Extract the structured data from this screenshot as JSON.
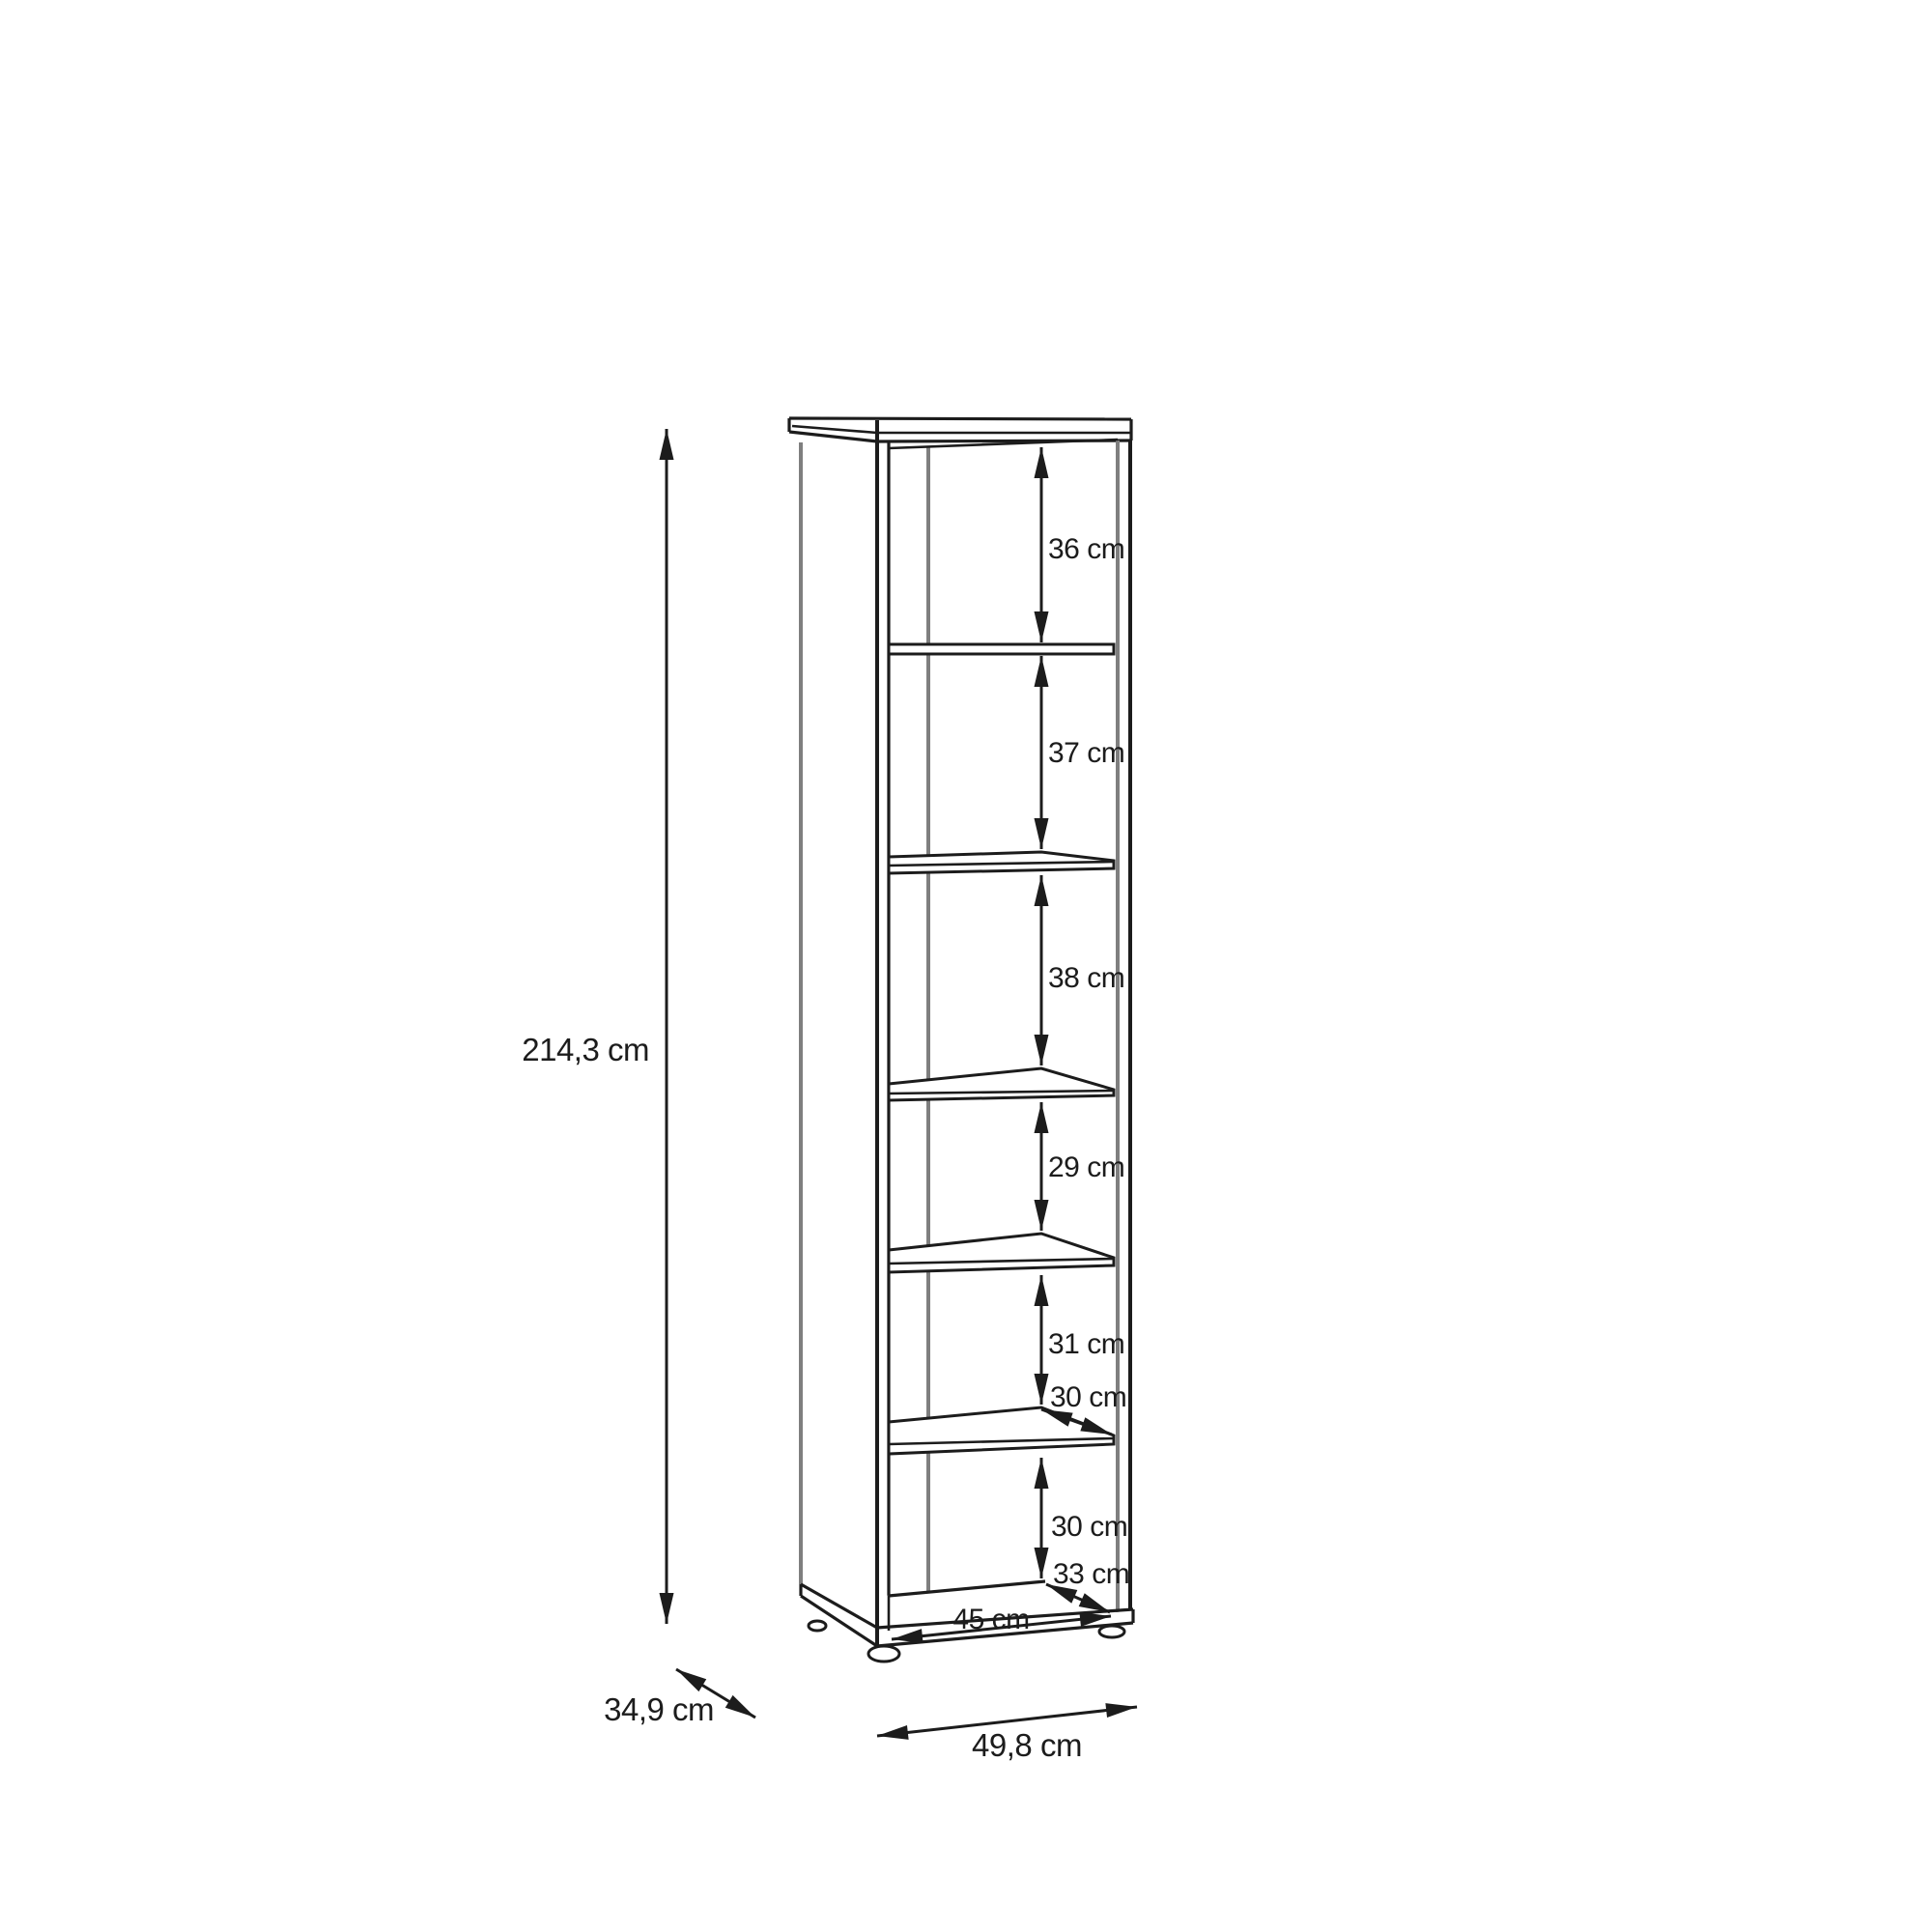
{
  "diagram": {
    "kind": "furniture-dimension-drawing",
    "subject": "tall open shelving unit with five shelves and adjustable feet",
    "unit": "cm",
    "colors": {
      "background": "#ffffff",
      "line": "#1c1c1c",
      "secondary_line": "#7f7f7f",
      "text": "#1c1c1c"
    },
    "overall": {
      "height": "214,3 cm",
      "width": "49,8 cm",
      "depth": "34,9 cm"
    },
    "interior": {
      "interior_width": "45 cm",
      "shelf_depth": "30 cm",
      "base_depth": "33 cm",
      "compartment_heights_top_to_bottom": [
        "36 cm",
        "37 cm",
        "38 cm",
        "29 cm",
        "31 cm",
        "30 cm"
      ]
    },
    "labels": {
      "height": "214,3 cm",
      "compartment_1": "36 cm",
      "compartment_2": "37 cm",
      "compartment_3": "38 cm",
      "compartment_4": "29 cm",
      "compartment_5": "31 cm",
      "shelf_depth": "30 cm",
      "compartment_6": "30 cm",
      "base_depth": "33 cm",
      "interior_width": "45 cm",
      "width": "49,8 cm",
      "depth": "34,9 cm"
    },
    "shelf_count": 5
  }
}
